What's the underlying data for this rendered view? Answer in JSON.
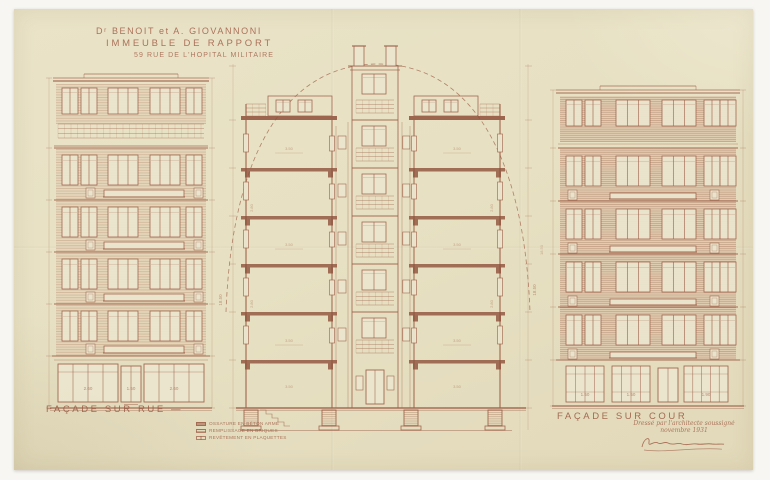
{
  "title": {
    "line1": "Dʳ BENOIT et A. GIOVANNONI",
    "line2": "IMMEUBLE DE RAPPORT",
    "line3": "59 RUE DE L'HOPITAL MILITAIRE"
  },
  "captions": {
    "facade_rue": "FAÇADE SUR RUE —",
    "facade_cour": "FAÇADE SUR COUR"
  },
  "legend": {
    "items": [
      {
        "key": "beton",
        "label": "OSSATURE EN BÉTON ARMÉ"
      },
      {
        "key": "briques",
        "label": "REMPLISSAGE EN BRIQUES"
      },
      {
        "key": "plaquettes",
        "label": "REVÊTEMENT EN PLAQUETTES"
      }
    ]
  },
  "note": {
    "line1": "Dressé par l'architecte soussigné",
    "line2": "novembre 1931"
  },
  "annotations": {
    "shop_dims_rue": [
      "2.60",
      "1.50",
      "2.60"
    ],
    "shop_dims_cour": [
      "1.50",
      "1.50",
      "1.90"
    ],
    "room_dim": "3.50",
    "floor_height": "2.80",
    "total_height": "18.50"
  },
  "colors": {
    "paper": "#e8e1c4",
    "ink": "#9b5b44",
    "ink_dark": "#8a4833",
    "brick": "#ddc9ae"
  }
}
